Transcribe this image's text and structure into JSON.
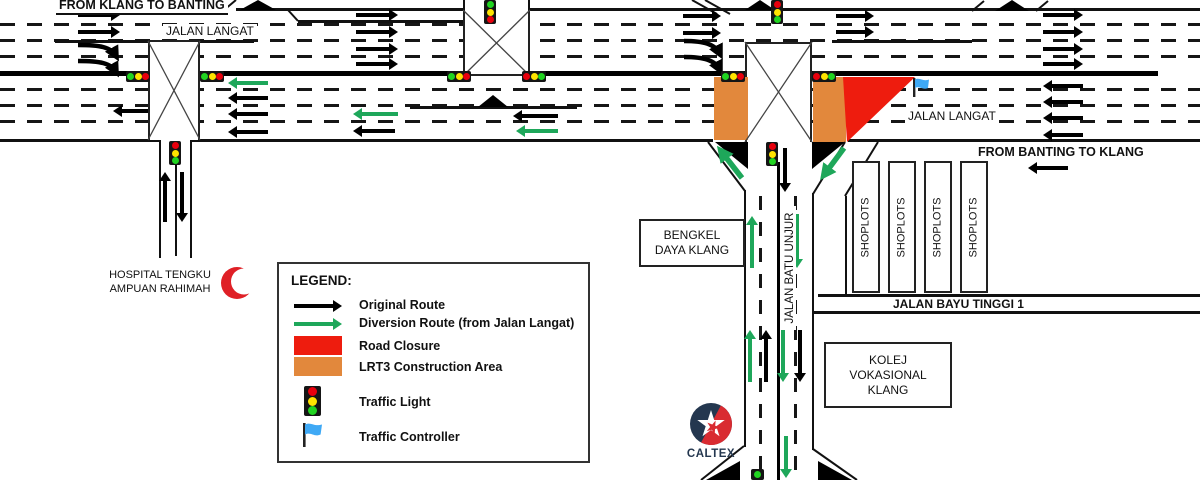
{
  "colors": {
    "diversion_green": "#1EA75A",
    "closure_red": "#EE1C0E",
    "construction_orange": "#E2883C",
    "controller_blue": "#3FA9F5",
    "caltex_navy": "#24374F",
    "caltex_red": "#D92B31",
    "crescent_red": "#DF2026"
  },
  "top": {
    "from_klang_to_banting": "FROM KLANG TO BANTING",
    "jalan_langat_left": "JALAN LANGAT",
    "jalan_langat_right": "JALAN LANGAT",
    "from_banting_to_klang": "FROM BANTING TO KLANG"
  },
  "roads": {
    "jalan_batu_unjur": "JALAN BATU UNJUR",
    "jalan_bayu_tinggi": "JALAN BAYU TINGGI 1"
  },
  "places": {
    "hospital_line1": "HOSPITAL TENGKU",
    "hospital_line2": "AMPUAN RAHIMAH",
    "bengkel_line1": "BENGKEL",
    "bengkel_line2": "DAYA KLANG",
    "kolej_line1": "KOLEJ",
    "kolej_line2": "VOKASIONAL",
    "kolej_line3": "KLANG",
    "shoplot": "SHOPLOTS",
    "caltex": "CALTEX"
  },
  "legend": {
    "title": "LEGEND:",
    "items": [
      {
        "icon": "black-arrow",
        "label": "Original Route"
      },
      {
        "icon": "green-arrow",
        "label": "Diversion Route (from Jalan Langat)"
      },
      {
        "icon": "red-rect",
        "label": "Road Closure"
      },
      {
        "icon": "orange-rect",
        "label": "LRT3 Construction Area"
      },
      {
        "icon": "traffic-light",
        "label": "Traffic Light"
      },
      {
        "icon": "blue-flag",
        "label": "Traffic Controller"
      }
    ]
  }
}
